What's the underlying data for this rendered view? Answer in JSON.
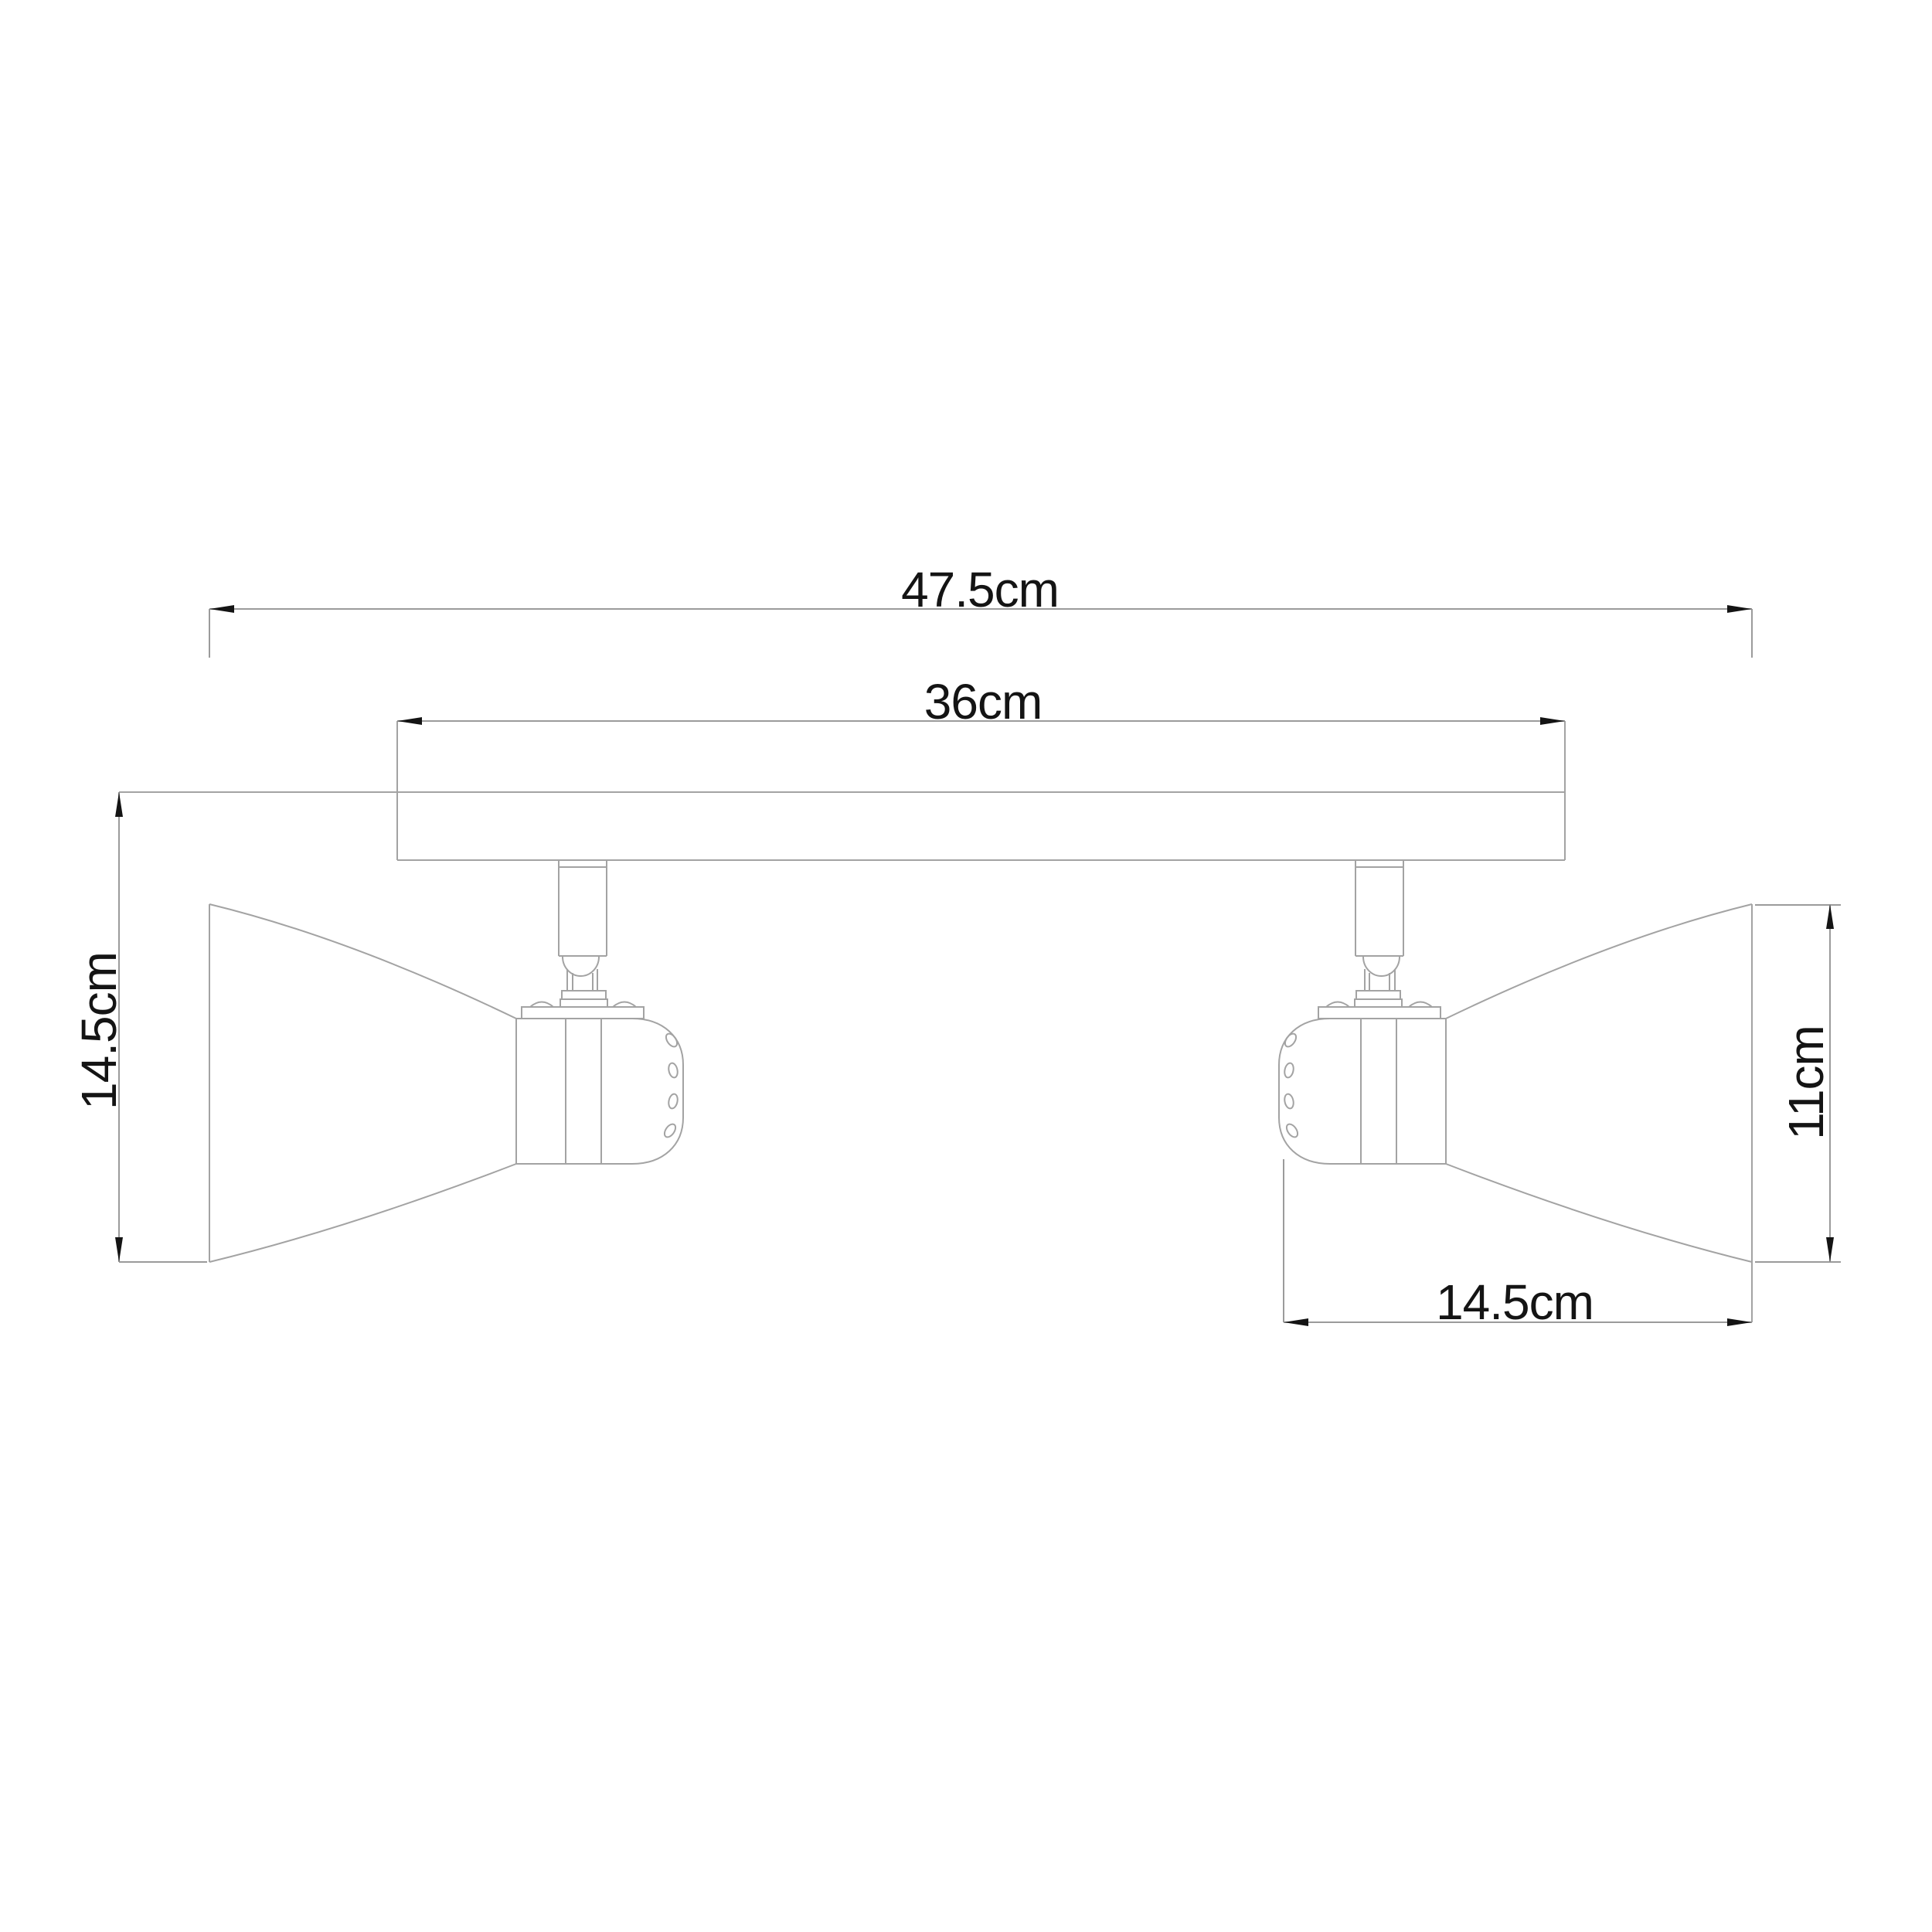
{
  "drawing": {
    "type": "technical-dimension-drawing",
    "subject": "two-head ceiling spotlight bar, side elevation",
    "unit": "cm",
    "background_color": "#ffffff",
    "line_color": "#a3a3a3",
    "arrow_color": "#141414",
    "text_color": "#141414",
    "dimensions": {
      "overall_width": {
        "label": "47.5cm",
        "value": 47.5,
        "orientation": "horizontal",
        "position": "top"
      },
      "bar_width": {
        "label": "36cm",
        "value": 36,
        "orientation": "horizontal",
        "position": "above-bar"
      },
      "fixture_height": {
        "label": "14.5cm",
        "value": 14.5,
        "orientation": "vertical",
        "position": "left"
      },
      "shade_opening": {
        "label": "11cm",
        "value": 11,
        "orientation": "vertical",
        "position": "right"
      },
      "head_length": {
        "label": "14.5cm",
        "value": 14.5,
        "orientation": "horizontal",
        "position": "bottom-right"
      }
    }
  }
}
